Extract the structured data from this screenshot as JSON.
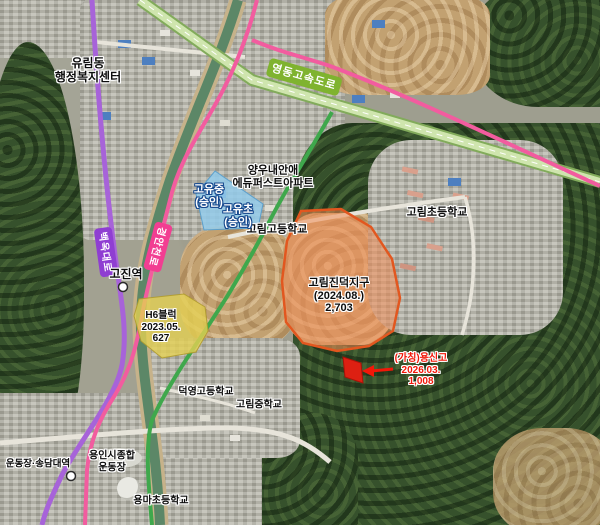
{
  "roads": {
    "expressway": "영동고속도로",
    "baekokdaero": "백옥대로",
    "gyeongancheonro": "경안천로"
  },
  "stations": {
    "gojin": "고진역",
    "stadium_songdam": "운동장·송담대역"
  },
  "places": {
    "yurim_line1": "유림동",
    "yurim_line2": "행정복지센터",
    "apt_line1": "양우내안애",
    "apt_line2": "에듀퍼스트아파트",
    "gorim_high": "고림고등학교",
    "gorim_elem": "고림초등학교",
    "deokyoung_high": "덕영고등학교",
    "gorim_middle": "고림중학교",
    "stadium_line1": "용인시종합",
    "stadium_line2": "운동장",
    "yongma_elem": "용마초등학교"
  },
  "zones": {
    "goyu_middle": {
      "name": "고유중",
      "status": "(승인)"
    },
    "goyu_elem": {
      "name": "고유초",
      "status": "(승인)"
    },
    "h6_block": {
      "name": "H6블럭",
      "date": "2023.05.",
      "units": "627"
    },
    "gorim_jindeok": {
      "name": "고림진덕지구",
      "date": "(2024.08.)",
      "units": "2,703"
    },
    "yongsin_school": {
      "name": "(가칭)용신고",
      "date": "2026.03.",
      "units": "1,008"
    }
  },
  "colors": {
    "expressway_label_bg": "#7fb32f",
    "baekok_label_bg": "#8f3ed2",
    "gyeongan_label_bg": "#f23e92",
    "blue_zone_fill": "#93cbeb",
    "yellow_zone_fill": "#e4d052",
    "orange_zone_fill": "#f08c55",
    "red_zone_fill": "#dd2012",
    "red_label_text": "#f21708"
  }
}
